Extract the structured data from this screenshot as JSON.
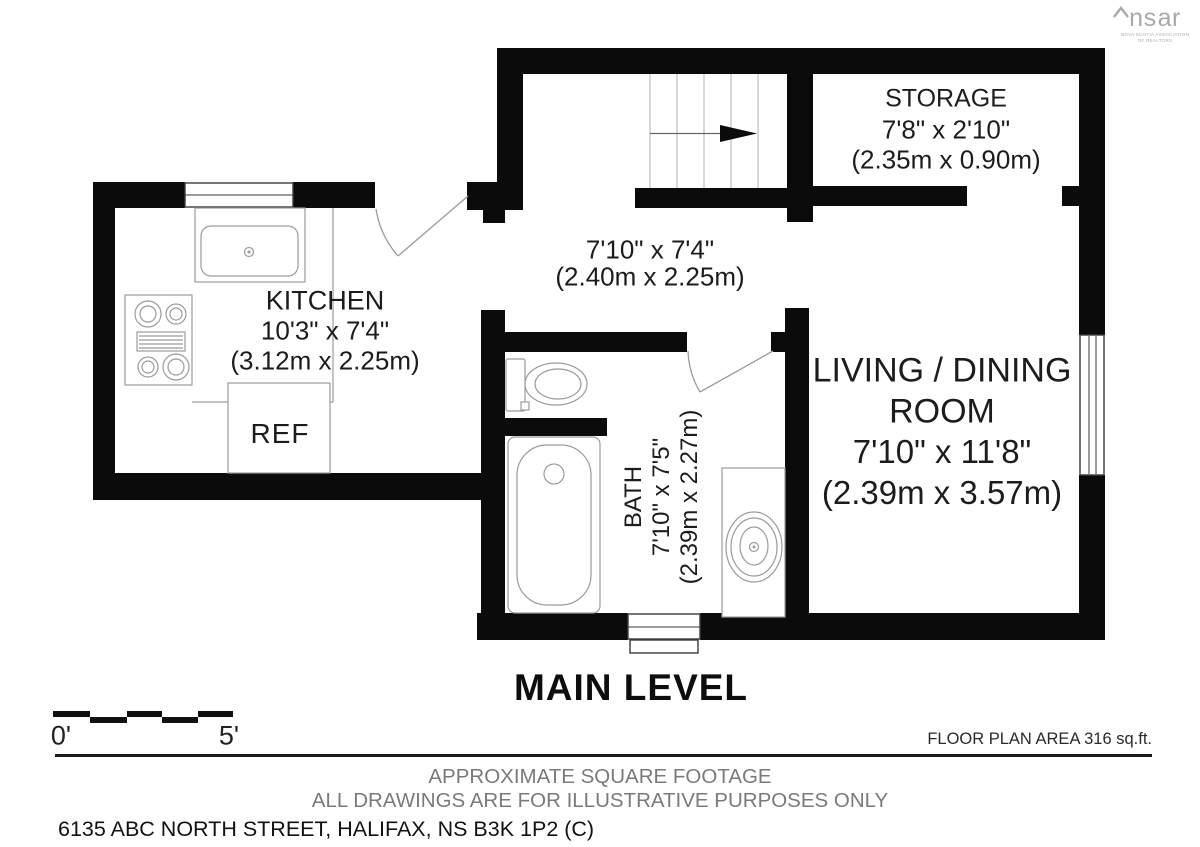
{
  "logo": {
    "brand_left": "ns",
    "brand_right": "ar",
    "tagline_line1": "NOVA SCOTIA ASSOCIATION",
    "tagline_line2": "OF REALTORS"
  },
  "rooms": {
    "storage": {
      "name": "STORAGE",
      "dim_imperial": "7'8\" x 2'10\"",
      "dim_metric": "(2.35m x 0.90m)"
    },
    "hall": {
      "dim_imperial": "7'10\" x 7'4\"",
      "dim_metric": "(2.40m x 2.25m)"
    },
    "kitchen": {
      "name": "KITCHEN",
      "dim_imperial": "10'3\" x 7'4\"",
      "dim_metric": "(3.12m x 2.25m)",
      "fridge_label": "REF"
    },
    "bath": {
      "name": "BATH",
      "dim_imperial": "7'10\" x 7'5\"",
      "dim_metric": "(2.39m x 2.27m)"
    },
    "living_dining": {
      "name_line1": "LIVING / DINING",
      "name_line2": "ROOM",
      "dim_imperial": "7'10\" x 11'8\"",
      "dim_metric": "(2.39m x 3.57m)"
    }
  },
  "title": "MAIN LEVEL",
  "scale_bar": {
    "start_label": "0'",
    "end_label": "5'"
  },
  "footer": {
    "area_note": "FLOOR PLAN AREA 316 sq.ft.",
    "disclaimer_line1": "APPROXIMATE SQUARE FOOTAGE",
    "disclaimer_line2": "ALL DRAWINGS ARE FOR ILLUSTRATIVE PURPOSES ONLY",
    "address": "6135 ABC NORTH STREET, HALIFAX, NS B3K 1P2 (C)"
  },
  "colors": {
    "wall": "#0b0b0b",
    "fixture": "#9b9b9b",
    "text": "#1c1c1c",
    "muted": "#7a7a7a",
    "logo": "#a9a9a9"
  }
}
